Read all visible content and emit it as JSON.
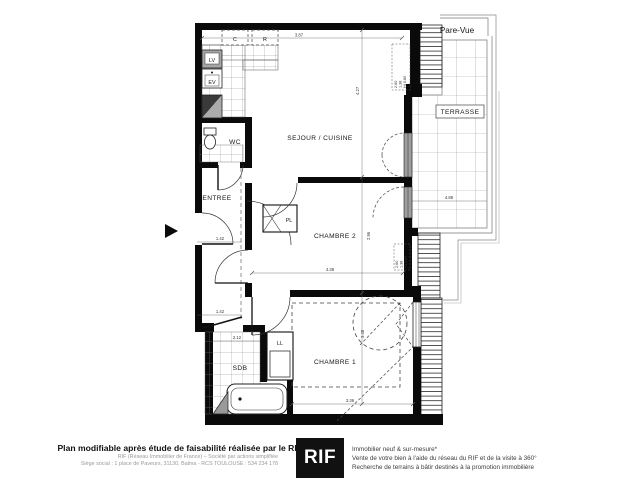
{
  "plan": {
    "title": "Pare-Vue",
    "rooms": {
      "sejour": "SEJOUR / CUISINE",
      "chambre1": "CHAMBRE 1",
      "chambre2": "CHAMBRE 2",
      "entree": "ENTREE",
      "wc": "WC",
      "sdb": "SDB",
      "terrasse": "TERRASSE",
      "placard": "PL",
      "lave_linge": "LL",
      "lave_vaisselle": "LV",
      "evier": "EV",
      "cellier": "C",
      "refrigerateur": "R"
    },
    "dimensions": {
      "kitchen_width": "3.87",
      "sejour_height": "4.27",
      "chambre2_width": "4.38",
      "chambre2_height": "2.96",
      "chambre1_width": "3.36",
      "chambre1_height": "3.48",
      "entree_width": "1.42",
      "couloir_width": "1.42",
      "sdb_width": "2.12",
      "terrasse_width": "4.88"
    },
    "window_note": [
      "2.60",
      "1.38",
      "Ht 0.80"
    ]
  },
  "footer": {
    "claim": "Plan modifiable après étude de faisabilité réalisée par le RIF",
    "legal_line1": "RIF (Réseau Immobilier de France) – Société par actions simplifiée",
    "legal_line2": "Siège social : 1 place de Paveurs, 31130, Balma - RCS TOULOUSE : 534 234 178",
    "logo": "RIF",
    "services": [
      "Immobilier neuf & sur-mesure*",
      "Vente de votre bien à l'aide du réseau du RIF et de la visite à 360°",
      "Recherche de terrains à bâtir destinés à la promotion immobilière"
    ]
  },
  "colors": {
    "wall": "#0a0a0a",
    "logo_bg": "#111111",
    "tile_line": "#8a8a8a",
    "dashed": "#555555"
  }
}
